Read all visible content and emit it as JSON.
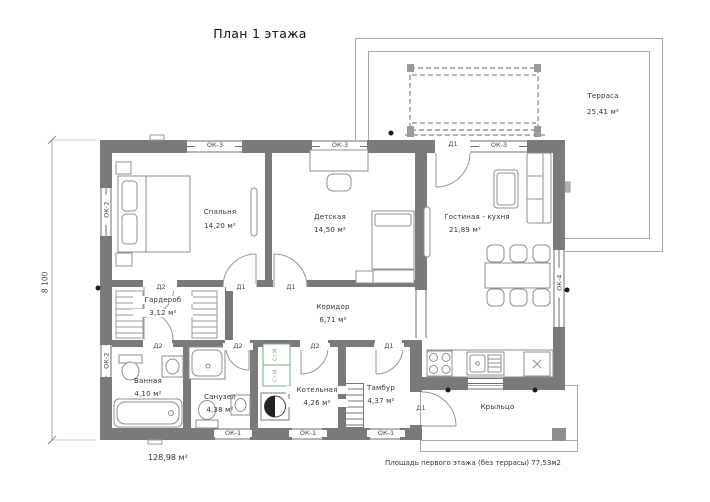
{
  "title": "План 1 этажа",
  "rooms": {
    "bedroom": {
      "name": "Спальня",
      "area": "14,20 м²"
    },
    "kids": {
      "name": "Детская",
      "area": "14,50 м²"
    },
    "living": {
      "name": "Гостиная - кухня",
      "area": "21,89 м²"
    },
    "wardrobe": {
      "name": "Гардероб",
      "area": "3,12 м²"
    },
    "corridor": {
      "name": "Коридор",
      "area": "6,71 м²"
    },
    "bath": {
      "name": "Ванная",
      "area": "4,10 м²"
    },
    "wc": {
      "name": "Санузел",
      "area": "4,38 м²"
    },
    "boiler": {
      "name": "Котельная",
      "area": "4,26 м²"
    },
    "vestibule": {
      "name": "Тамбур",
      "area": "4,37 м²"
    },
    "terrace": {
      "name": "Терраса",
      "area": "25,41 м²"
    },
    "porch": {
      "name": "Крыльцо"
    }
  },
  "openings": {
    "ok1": "ОК-1",
    "ok2": "ОК-2",
    "ok3": "ОК-3",
    "ok4": "ОК-4",
    "d1": "Д1",
    "d2": "Д2"
  },
  "annotations": {
    "dimension_height": "8 100",
    "building_area": "128,98 м²",
    "floor_area_note": "Площадь первого этажа (без террасы)  77,53м2",
    "washing_machine": "Ст.М."
  },
  "colors": {
    "wall": "#7a7a7a",
    "line": "#8f8f8f",
    "accent_green": "#7aab7f"
  }
}
